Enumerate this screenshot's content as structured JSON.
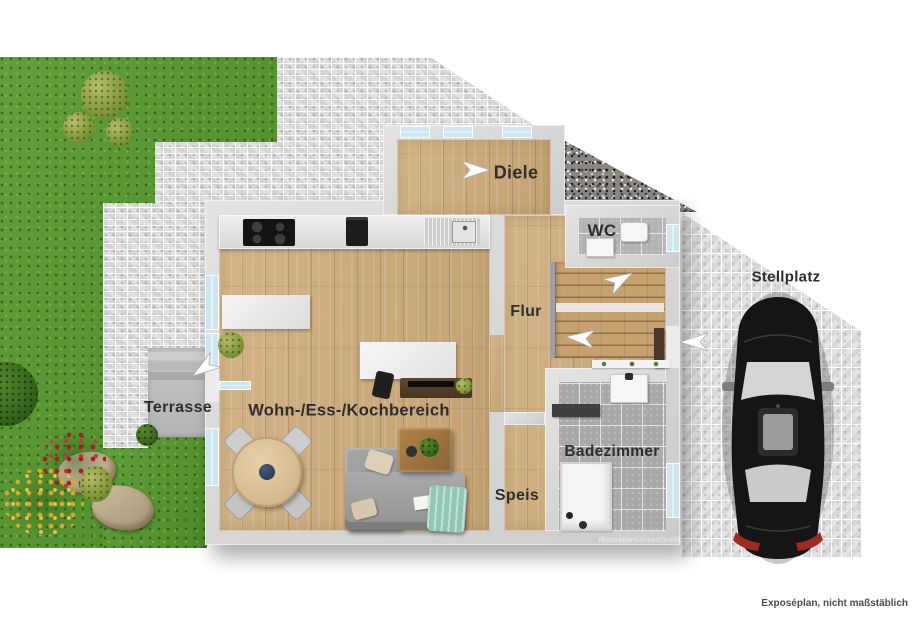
{
  "rooms": {
    "diele": "Diele",
    "wc": "WC",
    "flur": "Flur",
    "wohnbereich": "Wohn-/Ess-/Kochbereich",
    "speis": "Speis",
    "badezimmer": "Badezimmer",
    "terrasse": "Terrasse",
    "stellplatz": "Stellplatz"
  },
  "annotations": {
    "watermark": "Illustration©immoGrafik",
    "footer_note": "Exposéplan, nicht maßstäblich"
  },
  "icons": {
    "direction_arrow": "white dart / paper-plane arrow",
    "car": "black sedan seen from above"
  },
  "colors": {
    "grass": "#55982c",
    "paving": "#dedede",
    "paving_light": "#e3e3e3",
    "gravel": "#8b8781",
    "wood": "#cfad7e",
    "tile": "#a9a9a9",
    "wall": "#d8d8d8",
    "car_body": "#151515",
    "taillight": "#9e2a20",
    "label_text": "#2e2e2e"
  }
}
